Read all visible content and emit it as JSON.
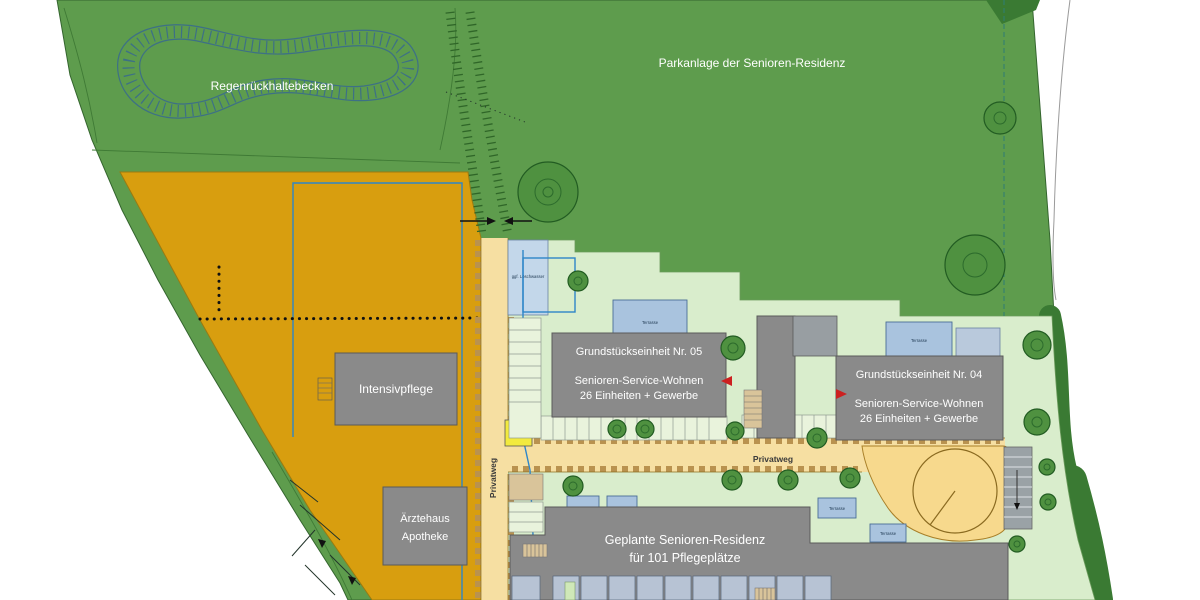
{
  "colors": {
    "park_green": "#5e9c4d",
    "dark_green": "#3a7a33",
    "pale_green": "#d9edcc",
    "orange": "#d89e0f",
    "road_yellow": "#f6dfa2",
    "building_gray": "#8a8a8a",
    "terrace_blue": "#a9c3de",
    "basin_blue": "#3d7086",
    "line_blue": "#2e86c8",
    "arrow_red": "#cc2020",
    "sign_yellow": "#f2ea3e"
  },
  "labels": {
    "basin": "Regenrückhaltebecken",
    "park": "Parkanlage der Senioren-Residenz",
    "intensivpflege": "Intensivpflege",
    "aerztehaus_line1": "Ärztehaus",
    "aerztehaus_line2": "Apotheke",
    "unit05_line1": "Grundstückseinheit Nr. 05",
    "unit05_line2": "Senioren-Service-Wohnen",
    "unit05_line3": "26 Einheiten + Gewerbe",
    "unit04_line1": "Grundstückseinheit Nr. 04",
    "unit04_line2": "Senioren-Service-Wohnen",
    "unit04_line3": "26 Einheiten + Gewerbe",
    "residenz_line1": "Geplante Senioren-Residenz",
    "residenz_line2": "für 101 Pflegeplätze",
    "privatweg": "Privatweg",
    "loeschwasser": "ggf. Löschwasser",
    "trafo_line1": "ggf. Trafo",
    "trafo_line2": "Station",
    "terrasse": "Terrasse"
  }
}
